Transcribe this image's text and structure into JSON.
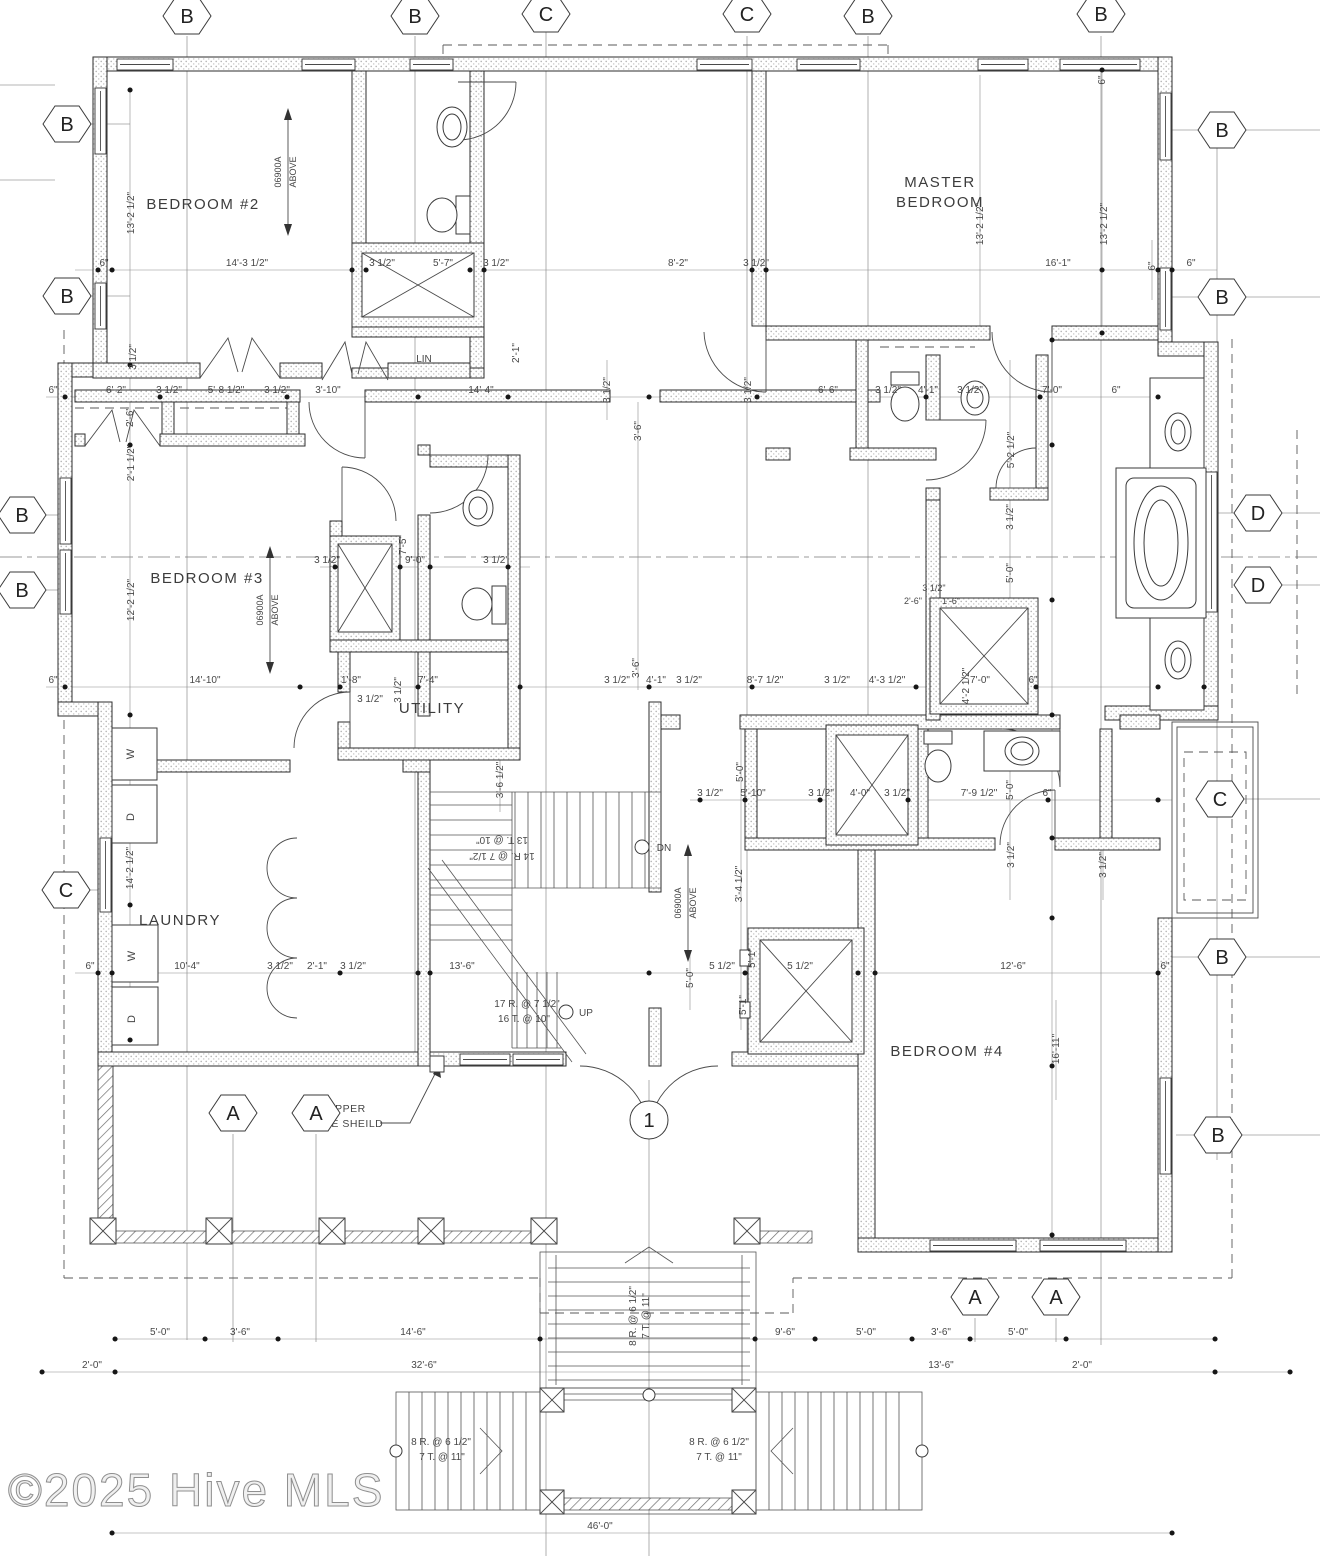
{
  "watermark": "©2025 Hive MLS",
  "rooms": {
    "bedroom2": "BEDROOM #2",
    "bedroom3": "BEDROOM #3",
    "bedroom4": "BEDROOM #4",
    "master1": "MASTER",
    "master2": "BEDROOM",
    "laundry": "LAUNDRY",
    "utility": "UTILITY",
    "linen": "LIN"
  },
  "markers": {
    "a": "A",
    "b": "B",
    "c": "C",
    "d": "D",
    "one": "1"
  },
  "labels": {
    "up": "UP",
    "dn": "DN",
    "w": "W",
    "d": "D",
    "above_code": "06900A",
    "above_word": "ABOVE",
    "copper1": "COPPER",
    "copper2": "LITE SHEILD"
  },
  "stairs": {
    "dn_r": "14 R. @ 7 1/2\"",
    "dn_t": "13 T. @ 10\"",
    "up_r": "17 R. @ 7 1/2\"",
    "up_t": "16 T. @ 10\"",
    "porch_r": "8 R. @ 6 1/2\"",
    "porch_t": "7 T. @ 11\""
  },
  "dims": {
    "row270": [
      "6\"",
      "14'-3 1/2\"",
      "3 1/2\"",
      "5'-7\"",
      "3 1/2\"",
      "8'-2\"",
      "3 1/2\"",
      "16'-1\"",
      "6\""
    ],
    "row397": [
      "6\"",
      "6'-2\"",
      "3 1/2\"",
      "5'-8 1/2\"",
      "3 1/2\"",
      "3'-10\"",
      "14'-4\"",
      "6'-6\"",
      "3 1/2\"",
      "4'-1\"",
      "3 1/2\"",
      "7'-0\"",
      "6\""
    ],
    "row567": [
      "3 1/2\"",
      "9'-0\"",
      "3 1/2\""
    ],
    "row687": [
      "6\"",
      "14'-10\"",
      "1'-8\"",
      "7'-4\"",
      "3 1/2\"",
      "4'-1\"",
      "3 1/2\"",
      "8'-7 1/2\"",
      "3 1/2\"",
      "4'-3 1/2\"",
      "7'-0\"",
      "6\""
    ],
    "row800": [
      "3 1/2\"",
      "5'-10\"",
      "3 1/2\"",
      "4'-0\"",
      "3 1/2\"",
      "7'-9 1/2\"",
      "6\""
    ],
    "row973": [
      "6\"",
      "10'-4\"",
      "3 1/2\"",
      "2'-1\"",
      "3 1/2\"",
      "13'-6\"",
      "5 1/2\"",
      "5 1/2\"",
      "12'-6\"",
      "6\""
    ],
    "row1339": [
      "5'-0\"",
      "3'-6\"",
      "14'-6\"",
      "9'-6\"",
      "5'-0\"",
      "3'-6\"",
      "5'-0\""
    ],
    "row1372": [
      "2'-0\"",
      "32'-6\"",
      "13'-6\"",
      "2'-0\""
    ],
    "overall": "46'-0\"",
    "vert": [
      "13'-2 1/2\"",
      "3 1/2\"",
      "2'-6\"",
      "2'-1 1/2\"",
      "12'-2 1/2\"",
      "14'-2 1/2\"",
      "13'-2 1/2\"",
      "13'-2 1/2\"",
      "6\"",
      "6\"",
      "5'-2 1/2\"",
      "3 1/2\"",
      "5'-0\"",
      "4'-2 1/2\"",
      "3 1/2\"",
      "5'-0\"",
      "3'-6\"",
      "3'-6\"",
      "3'-6 1/2\"",
      "2'-1\"",
      "3 1/2\"",
      "5'-0\"",
      "5'-1\"",
      "5'-1\"",
      "16'-11\"",
      "3 1/2\"",
      "3'-4 1/2\"",
      "7'-5\"",
      "3 1/2\"",
      "3 1/2\"",
      "5'-0\""
    ],
    "misc": [
      "2'-6\"",
      "1'-6\"",
      "3 1/2\"",
      "3 1/2\""
    ]
  }
}
